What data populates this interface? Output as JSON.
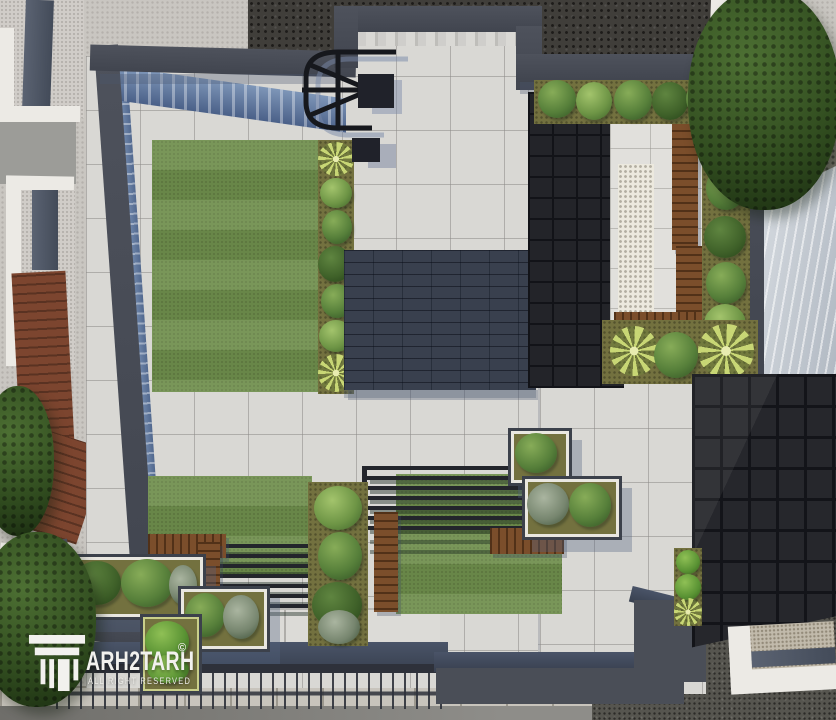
{
  "scene": {
    "kind": "3D architectural render, top-down aerial view",
    "subject": "Rooftop courtyard landscape design with lawns, raised planters, wooden benches, pergola slats, stone paving and dark shingle roofs",
    "elements": [
      "main-lawn",
      "planting-strip",
      "central-shingle-roof",
      "stair-railing",
      "black-tile-roof",
      "roof-garden-patio",
      "wooden-bench",
      "wood-deck-border",
      "shrub-bed",
      "palm-plant",
      "center-lawn-pergola",
      "l-shaped-planter",
      "stone-paving",
      "gravel-patio",
      "perimeter-wall",
      "street-fence",
      "sidewalk",
      "dark-grid-roof",
      "metal-seam-roof",
      "neighbor-buildings",
      "tree-canopy"
    ]
  },
  "watermark": {
    "brand": "ARH2TARH",
    "brand_displayed": "TARH2TARH",
    "copyright": "©",
    "tagline": "ALL RIGHT RESERVED",
    "logo": "classical-column-icon"
  },
  "palette": {
    "stucco": "#c9c6c1",
    "paving": "#d9d8d4",
    "paving2": "#e1e0dc",
    "grass": "#6f8e4c",
    "wall": "#4e525c",
    "navy": "#4a5468",
    "shingle": "#39404e",
    "blacktile": "#232429",
    "gridroof": "#26272c",
    "wood": "#7b4e2b",
    "soil": "#73713f",
    "glass": "#8ba3c4",
    "metal": "#e2e6ea",
    "graveldark": "#403e3a",
    "white_trim": "#eceae5",
    "watermark": "#f2f1ee"
  }
}
